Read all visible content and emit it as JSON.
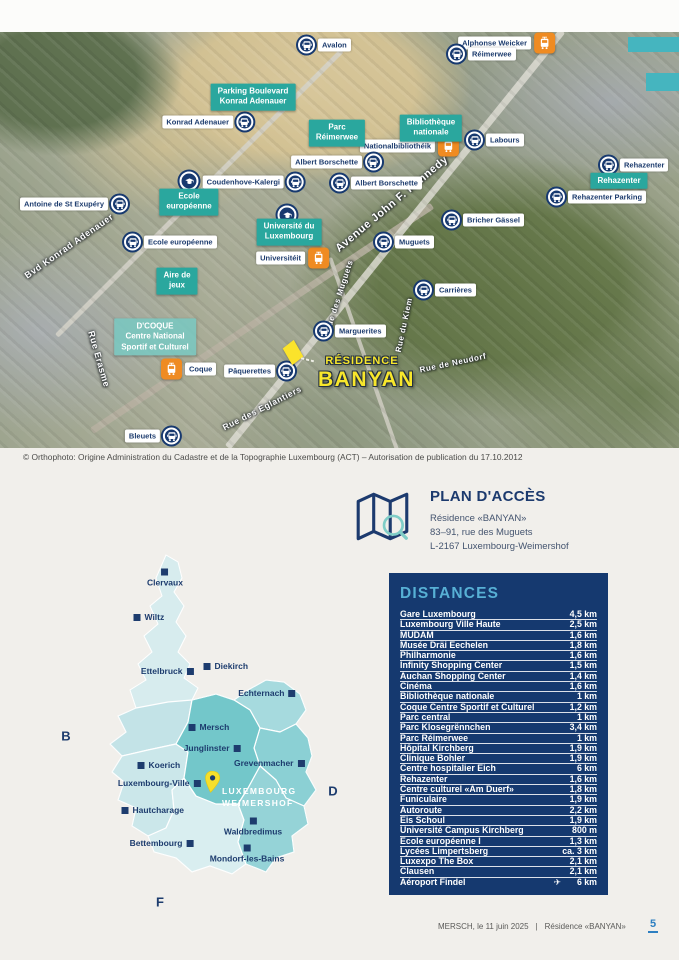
{
  "colors": {
    "teal": "#2aa79e",
    "navy": "#1d3c6e",
    "orange": "#ef8b22",
    "yellow": "#f7e62c",
    "panel": "#15396f",
    "panel_title": "#57b0d5",
    "page_number_blue": "#2d7fc1"
  },
  "aerial": {
    "copyright": "© Orthophoto: Origine Administration du Cadastre et de la Topographie Luxembourg (ACT) – Autorisation de publication du 17.10.2012",
    "residence": {
      "top": "RÉSIDENCE",
      "main": "BANYAN"
    },
    "streets": [
      {
        "text": "Avenue John F. Kennedy",
        "x": 392,
        "y": 172,
        "rot": -40,
        "size": 11
      },
      {
        "text": "Bvd Konrad Adenauer",
        "x": 69,
        "y": 214,
        "rot": -35,
        "size": 9
      },
      {
        "text": "Rue Erasme",
        "x": 99,
        "y": 327,
        "rot": 74,
        "size": 9
      },
      {
        "text": "Rue des Muguets",
        "x": 339,
        "y": 264,
        "rot": -72,
        "size": 8
      },
      {
        "text": "Rue du Kiem",
        "x": 404,
        "y": 293,
        "rot": -78,
        "size": 8
      },
      {
        "text": "Rue des Eglantiers",
        "x": 262,
        "y": 376,
        "rot": -27,
        "size": 8.5
      },
      {
        "text": "Rue de Neudorf",
        "x": 453,
        "y": 331,
        "rot": -12,
        "size": 8
      }
    ],
    "pois": [
      {
        "lines": [
          "Parking Boulevard",
          "Konrad Adenauer"
        ],
        "x": 253,
        "y": 65
      },
      {
        "lines": [
          "Parc",
          "Réimerwee"
        ],
        "x": 337,
        "y": 101
      },
      {
        "lines": [
          "Bibliothèque",
          "nationale"
        ],
        "x": 431,
        "y": 96
      },
      {
        "lines": [
          "Ecole",
          "européenne"
        ],
        "x": 189,
        "y": 170
      },
      {
        "lines": [
          "Université du",
          "Luxembourg"
        ],
        "x": 289,
        "y": 200
      },
      {
        "lines": [
          "Aire de",
          "jeux"
        ],
        "x": 177,
        "y": 249
      },
      {
        "lines": [
          "Rehazenter"
        ],
        "x": 619,
        "y": 149
      },
      {
        "lines": [
          "D'COQUE",
          "Centre National",
          "Sportif et Culturel"
        ],
        "x": 155,
        "y": 305,
        "variant": "light"
      }
    ],
    "stops": [
      {
        "label": "Avalon",
        "x": 310,
        "y": 13,
        "icon": "bus",
        "side": "right"
      },
      {
        "label": "Alphonse Weicker",
        "x": 543,
        "y": 11,
        "icon": "tram",
        "side": "left"
      },
      {
        "label": "Réimerwee",
        "x": 460,
        "y": 22,
        "icon": "bus",
        "side": "right"
      },
      {
        "label": "Nationalbibliothéik",
        "x": 447,
        "y": 114,
        "icon": "tram",
        "side": "left"
      },
      {
        "label": "Labours",
        "x": 478,
        "y": 108,
        "icon": "bus",
        "side": "right"
      },
      {
        "label": "Rehazenter",
        "x": 612,
        "y": 133,
        "icon": "bus",
        "side": "right"
      },
      {
        "label": "Rehazenter Parking",
        "x": 560,
        "y": 165,
        "icon": "bus",
        "side": "right"
      },
      {
        "label": "Bricher Gässel",
        "x": 455,
        "y": 188,
        "icon": "bus",
        "side": "right"
      },
      {
        "label": "Albert Borschette",
        "x": 370,
        "y": 130,
        "icon": "bus",
        "side": "left"
      },
      {
        "label": "Albert Borschette",
        "x": 343,
        "y": 151,
        "icon": "bus",
        "side": "right"
      },
      {
        "label": "Konrad Adenauer",
        "x": 241,
        "y": 90,
        "icon": "bus",
        "side": "left"
      },
      {
        "label": "Coudenhove-Kalergi",
        "x": 292,
        "y": 150,
        "icon": "bus",
        "side": "left"
      },
      {
        "label": "Antoine de St Exupéry",
        "x": 116,
        "y": 172,
        "icon": "bus",
        "side": "left"
      },
      {
        "label": "Ecole européenne",
        "x": 136,
        "y": 210,
        "icon": "bus",
        "side": "right"
      },
      {
        "label": "Universitéit",
        "x": 317,
        "y": 226,
        "icon": "tram",
        "side": "left"
      },
      {
        "label": "Muguets",
        "x": 387,
        "y": 210,
        "icon": "bus",
        "side": "right"
      },
      {
        "label": "Carrières",
        "x": 427,
        "y": 258,
        "icon": "bus",
        "side": "right"
      },
      {
        "label": "Marguerites",
        "x": 327,
        "y": 299,
        "icon": "bus",
        "side": "right"
      },
      {
        "label": "Pâquerettes",
        "x": 283,
        "y": 339,
        "icon": "bus",
        "side": "left"
      },
      {
        "label": "Coque",
        "x": 173,
        "y": 337,
        "icon": "tram",
        "side": "right"
      },
      {
        "label": "Bleuets",
        "x": 168,
        "y": 404,
        "icon": "bus",
        "side": "left"
      }
    ],
    "schools": [
      {
        "x": 189,
        "y": 149
      },
      {
        "x": 287,
        "y": 183
      }
    ],
    "deco": [
      {
        "x": 628,
        "y": 5,
        "w": 51,
        "h": 15
      },
      {
        "x": 646,
        "y": 41,
        "w": 33,
        "h": 18
      }
    ]
  },
  "access": {
    "title": "PLAN D'ACCÈS",
    "lines": [
      "Résidence «BANYAN»",
      "83–91, rue des Muguets",
      "L-2167 Luxembourg-Weimershof"
    ]
  },
  "luxmap": {
    "highlight": [
      "LUXEMBOURG",
      "WEIMERSHOF"
    ],
    "cities": [
      {
        "name": "Clervaux",
        "x": 135,
        "y": 20,
        "side": "below"
      },
      {
        "name": "Wiltz",
        "x": 107,
        "y": 65,
        "side": "right"
      },
      {
        "name": "Ettelbruck",
        "x": 160,
        "y": 119,
        "side": "left"
      },
      {
        "name": "Diekirch",
        "x": 177,
        "y": 114,
        "side": "right"
      },
      {
        "name": "Echternach",
        "x": 262,
        "y": 141,
        "side": "left"
      },
      {
        "name": "Mersch",
        "x": 162,
        "y": 175,
        "side": "right"
      },
      {
        "name": "Junglinster",
        "x": 207,
        "y": 196,
        "side": "left"
      },
      {
        "name": "Grevenmacher",
        "x": 271,
        "y": 211,
        "side": "left"
      },
      {
        "name": "Koerich",
        "x": 111,
        "y": 213,
        "side": "right"
      },
      {
        "name": "Luxembourg-Ville",
        "x": 167,
        "y": 231,
        "side": "left"
      },
      {
        "name": "Hautcharage",
        "x": 95,
        "y": 258,
        "side": "right"
      },
      {
        "name": "Bettembourg",
        "x": 160,
        "y": 291,
        "side": "left"
      },
      {
        "name": "Waldbredimus",
        "x": 223,
        "y": 269,
        "side": "below"
      },
      {
        "name": "Mondorf-les-Bains",
        "x": 217,
        "y": 296,
        "side": "below"
      }
    ],
    "letters": [
      {
        "text": "B",
        "x": 36,
        "y": 184
      },
      {
        "text": "D",
        "x": 303,
        "y": 239
      },
      {
        "text": "F",
        "x": 130,
        "y": 350
      }
    ]
  },
  "distances": {
    "title": "DISTANCES",
    "rows": [
      {
        "name": "Gare Luxembourg",
        "value": "4,5 km"
      },
      {
        "name": "Luxembourg Ville Haute",
        "value": "2,5 km"
      },
      {
        "name": "MUDAM",
        "value": "1,6 km"
      },
      {
        "name": "Musée Dräi Eechelen",
        "value": "1,8 km"
      },
      {
        "name": "Philharmonie",
        "value": "1,6 km"
      },
      {
        "name": "Infinity Shopping Center",
        "value": "1,5 km"
      },
      {
        "name": "Auchan Shopping Center",
        "value": "1,4 km"
      },
      {
        "name": "Cinéma",
        "value": "1,6 km"
      },
      {
        "name": "Bibliothèque nationale",
        "value": "1 km"
      },
      {
        "name": "Coque Centre Sportif et Culturel",
        "value": "1,2 km"
      },
      {
        "name": "Parc central",
        "value": "1 km"
      },
      {
        "name": "Parc Klosegrënnchen",
        "value": "3,4 km"
      },
      {
        "name": "Parc Réimerwee",
        "value": "1 km"
      },
      {
        "name": "Hôpital Kirchberg",
        "value": "1,9 km"
      },
      {
        "name": "Clinique Bohler",
        "value": "1,9 km"
      },
      {
        "name": "Centre hospitalier Eich",
        "value": "6 km"
      },
      {
        "name": "Rehazenter",
        "value": "1,6 km"
      },
      {
        "name": "Centre culturel «Am Duerf»",
        "value": "1,8 km"
      },
      {
        "name": "Funiculaire",
        "value": "1,9 km"
      },
      {
        "name": "Autoroute",
        "value": "2,2 km"
      },
      {
        "name": "Eis Schoul",
        "value": "1,9 km"
      },
      {
        "name": "Université Campus Kirchberg",
        "value": "800 m"
      },
      {
        "name": "Ecole européenne I",
        "value": "1,3 km"
      },
      {
        "name": "Lycées Limpertsberg",
        "value": "ca. 3 km"
      },
      {
        "name": "Luxexpo The Box",
        "value": "2,1 km"
      },
      {
        "name": "Clausen",
        "value": "2,1 km"
      },
      {
        "name": "Aéroport Findel",
        "value": "6 km",
        "plane": true
      }
    ]
  },
  "footer": {
    "left": "MERSCH, le 11 juin 2025",
    "sep": "|",
    "right": "Résidence «BANYAN»",
    "page": "5"
  }
}
